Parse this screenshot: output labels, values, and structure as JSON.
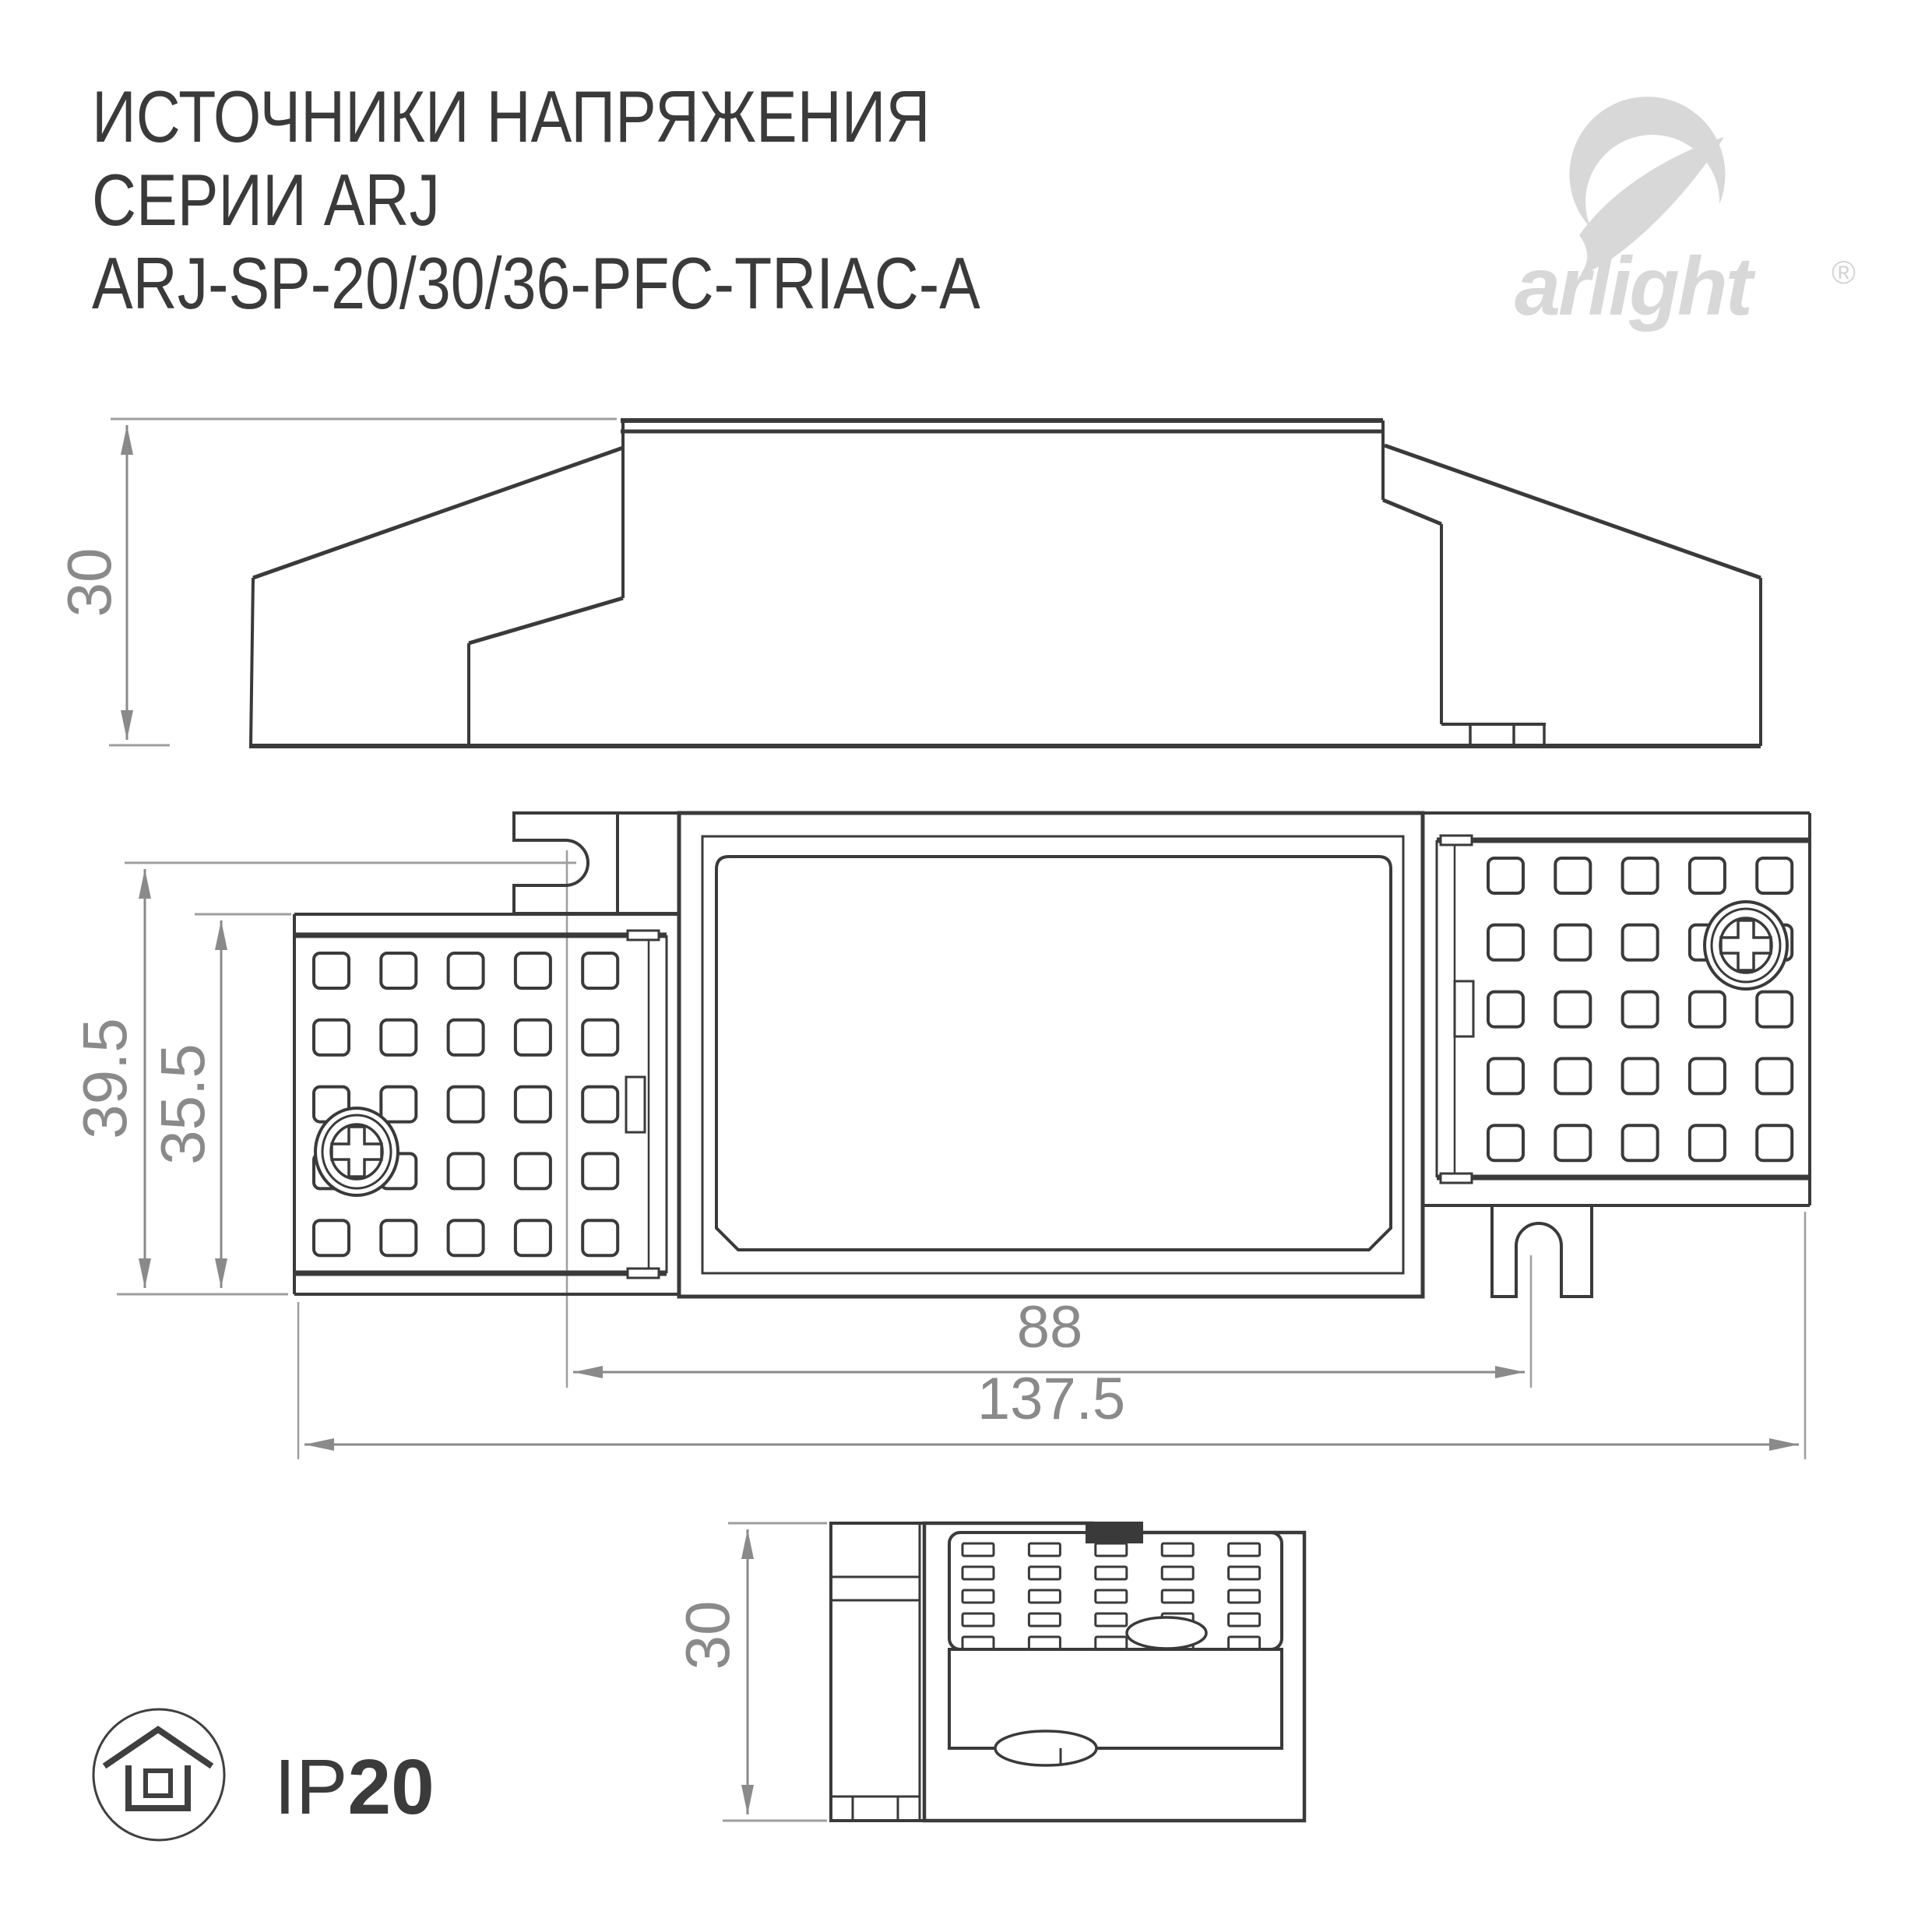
{
  "header": {
    "title_line1": "ИСТОЧНИКИ НАПРЯЖЕНИЯ",
    "title_line2": "СЕРИИ ARJ",
    "title_line3": "ARJ-SP-20/30/36-PFC-TRIAC-A"
  },
  "logo": {
    "brand": "arlight",
    "registered": "®",
    "color": "#d8d8d8"
  },
  "ip_badge": {
    "prefix": "IP",
    "rating": "20"
  },
  "dimensions": {
    "side_height": "30",
    "plan_outer_height": "39.5",
    "plan_inner_height": "35.5",
    "mount_hole_spacing": "88",
    "overall_length": "137.5",
    "end_height": "30"
  },
  "colors": {
    "line": "#3a3a3a",
    "dimension": "#8a8a8a",
    "extension": "#9e9e9e",
    "background": "#ffffff"
  }
}
